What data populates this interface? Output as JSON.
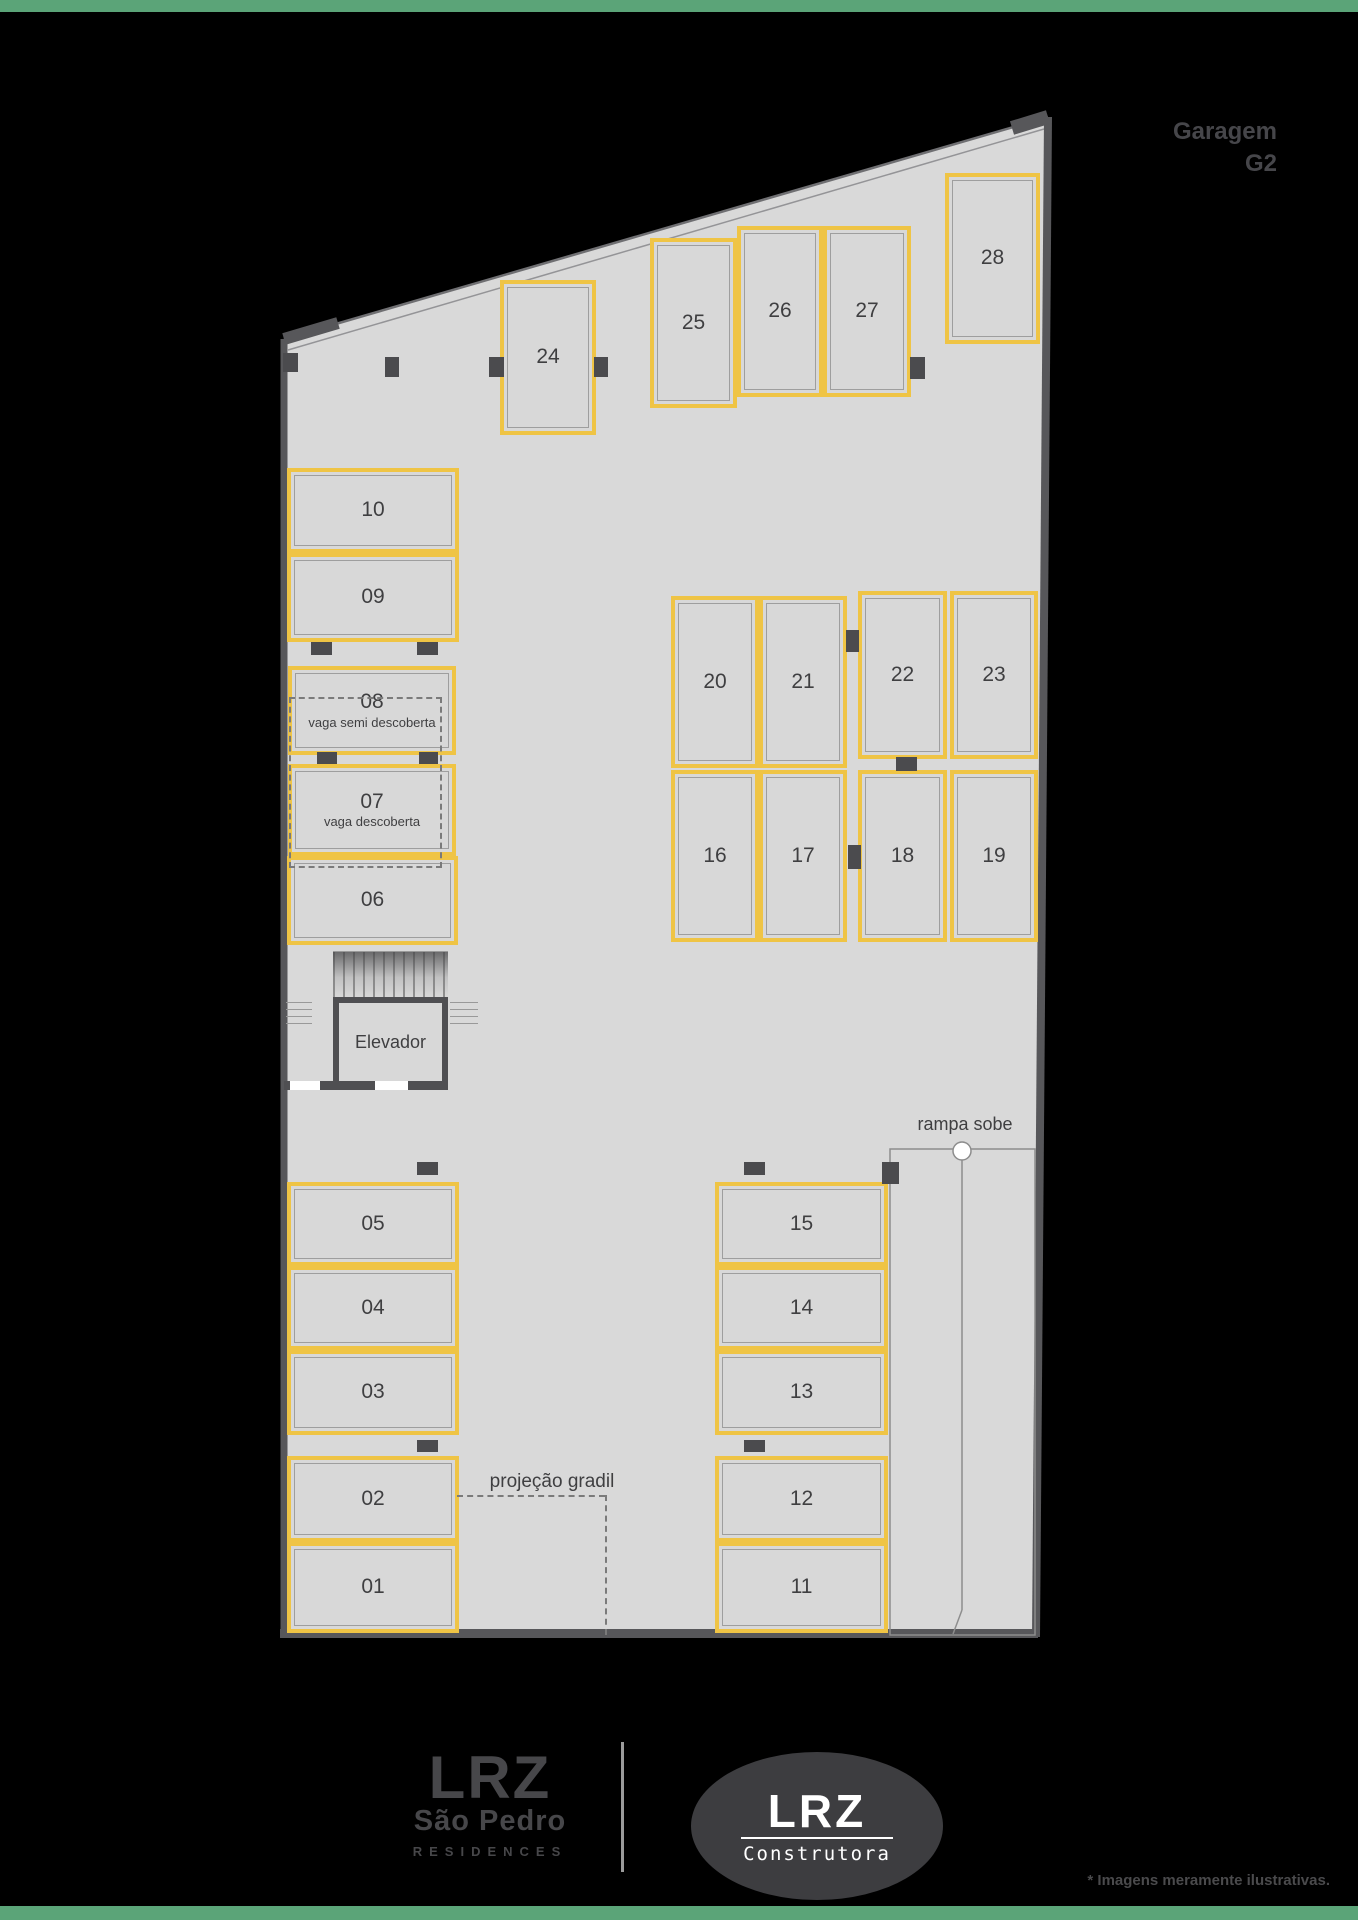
{
  "page": {
    "title_line1": "Garagem",
    "title_line2": "G2",
    "disclaimer": "* Imagens meramente ilustrativas."
  },
  "plan": {
    "elevator_label": "Elevador",
    "ramp_label": "rampa sobe",
    "gradil_label": "projeção gradil"
  },
  "spaces": [
    {
      "label": "01"
    },
    {
      "label": "02"
    },
    {
      "label": "03"
    },
    {
      "label": "04"
    },
    {
      "label": "05"
    },
    {
      "label": "06"
    },
    {
      "label": "07",
      "note": "vaga descoberta"
    },
    {
      "label": "08",
      "note": "vaga semi descoberta"
    },
    {
      "label": "09"
    },
    {
      "label": "10"
    },
    {
      "label": "11"
    },
    {
      "label": "12"
    },
    {
      "label": "13"
    },
    {
      "label": "14"
    },
    {
      "label": "15"
    },
    {
      "label": "16"
    },
    {
      "label": "17"
    },
    {
      "label": "18"
    },
    {
      "label": "19"
    },
    {
      "label": "20"
    },
    {
      "label": "21"
    },
    {
      "label": "22"
    },
    {
      "label": "23"
    },
    {
      "label": "24"
    },
    {
      "label": "25"
    },
    {
      "label": "26"
    },
    {
      "label": "27"
    },
    {
      "label": "28"
    }
  ],
  "footer": {
    "brand_residences": {
      "line1": "LRZ",
      "line2": "São Pedro",
      "line3": "RESIDENCES"
    },
    "brand_construtora": {
      "name": "LRZ",
      "sub": "Construtora"
    }
  },
  "colors": {
    "accent_yellow": "#EFC445",
    "wall": "#57575A",
    "floor": "#D9D9D9",
    "green_bar": "#5BA478",
    "text_dark": "#3F3F41"
  }
}
